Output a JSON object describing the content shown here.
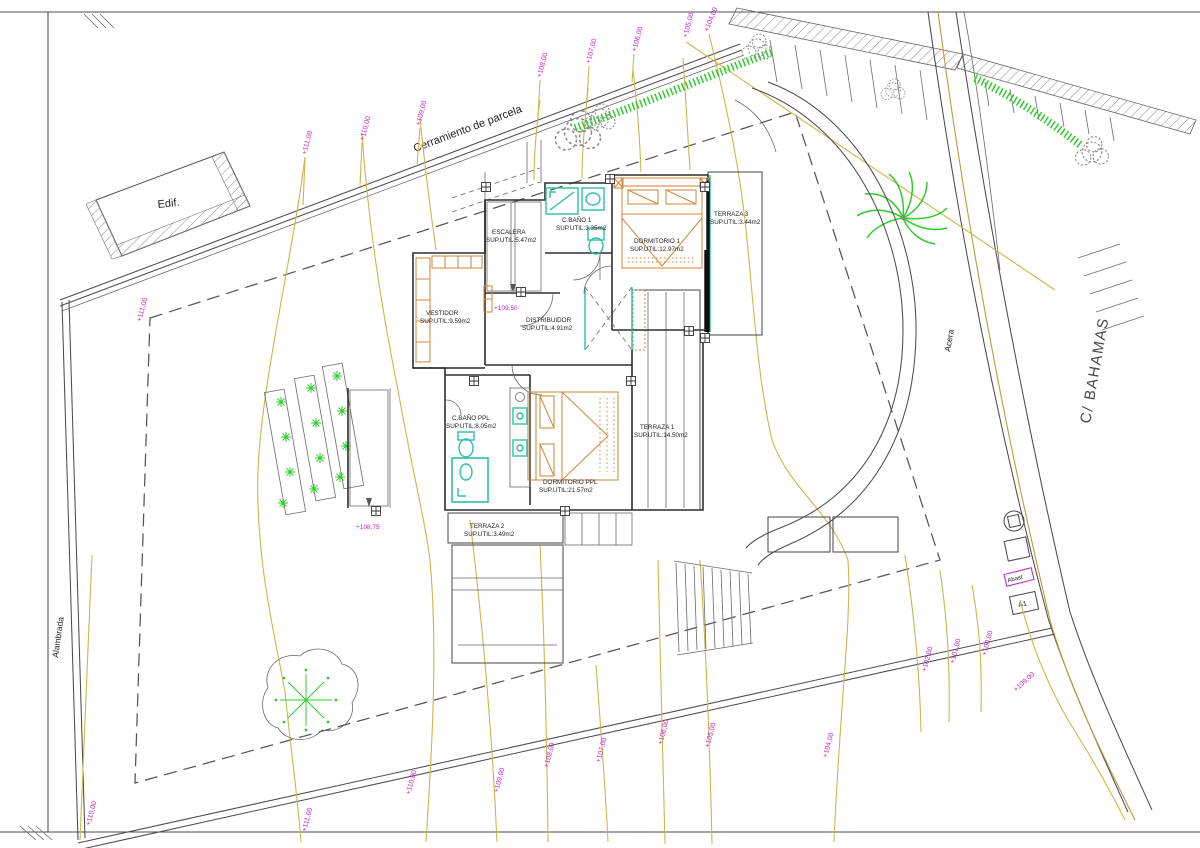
{
  "sheet": {
    "street_label": "C/ BAHAMAS",
    "fence_label": "Cerramiento de parcela",
    "building_label": "Edif.",
    "left_fence_label": "Alambrada",
    "sidewalk_label": "Acera",
    "utility_label": "Abast",
    "marker_label": "A1"
  },
  "rooms": [
    {
      "name": "ESCALERA",
      "area": "SUP.UTIL:5.47m2"
    },
    {
      "name": "C.BAÑO 1",
      "area": "SUP.UTIL:3.35m2"
    },
    {
      "name": "DORMITORIO 1",
      "area": "SUP.UTIL:12.97m2"
    },
    {
      "name": "TERRAZA 3",
      "area": "SUP.UTIL:3.44m2"
    },
    {
      "name": "VESTIDOR",
      "area": "SUP.UTIL:9.59m2"
    },
    {
      "name": "DISTRIBUIDOR",
      "area": "SUP.UTIL:4.91m2"
    },
    {
      "name": "C.BAÑO PPL",
      "area": "SUP.UTIL:8.05m2"
    },
    {
      "name": "DORMITORIO PPL",
      "area": "SUP.UTIL:21.57m2"
    },
    {
      "name": "TERRAZA 1",
      "area": "SUP.UTIL:14.50m2"
    },
    {
      "name": "TERRAZA 2",
      "area": "SUP.UTIL:3.49m2"
    }
  ],
  "levels": {
    "upper": "+109,50",
    "lower": "+108,75"
  },
  "contours": {
    "top": [
      "+111,00",
      "+110,00",
      "+109,00",
      "+108,00",
      "+107,00",
      "+106,00",
      "+105,00",
      "+104,00"
    ],
    "left": [
      "+111,00"
    ],
    "bottom": [
      "+110,00",
      "+111,00",
      "+110,00",
      "+109,00",
      "+108,00",
      "+107,00",
      "+106,00",
      "+105,00",
      "+104,00"
    ],
    "right": [
      "+102,00",
      "+101,00",
      "+100,00",
      "+109,00"
    ]
  },
  "colors": {
    "elevation_text": "#c81ec8",
    "contour_line": "#d2b44a",
    "fixtures": "#2cbfa9",
    "furniture": "#cf8a3d",
    "vegetation": "#2ecc2e",
    "drawing_line": "#4c4c4c"
  }
}
